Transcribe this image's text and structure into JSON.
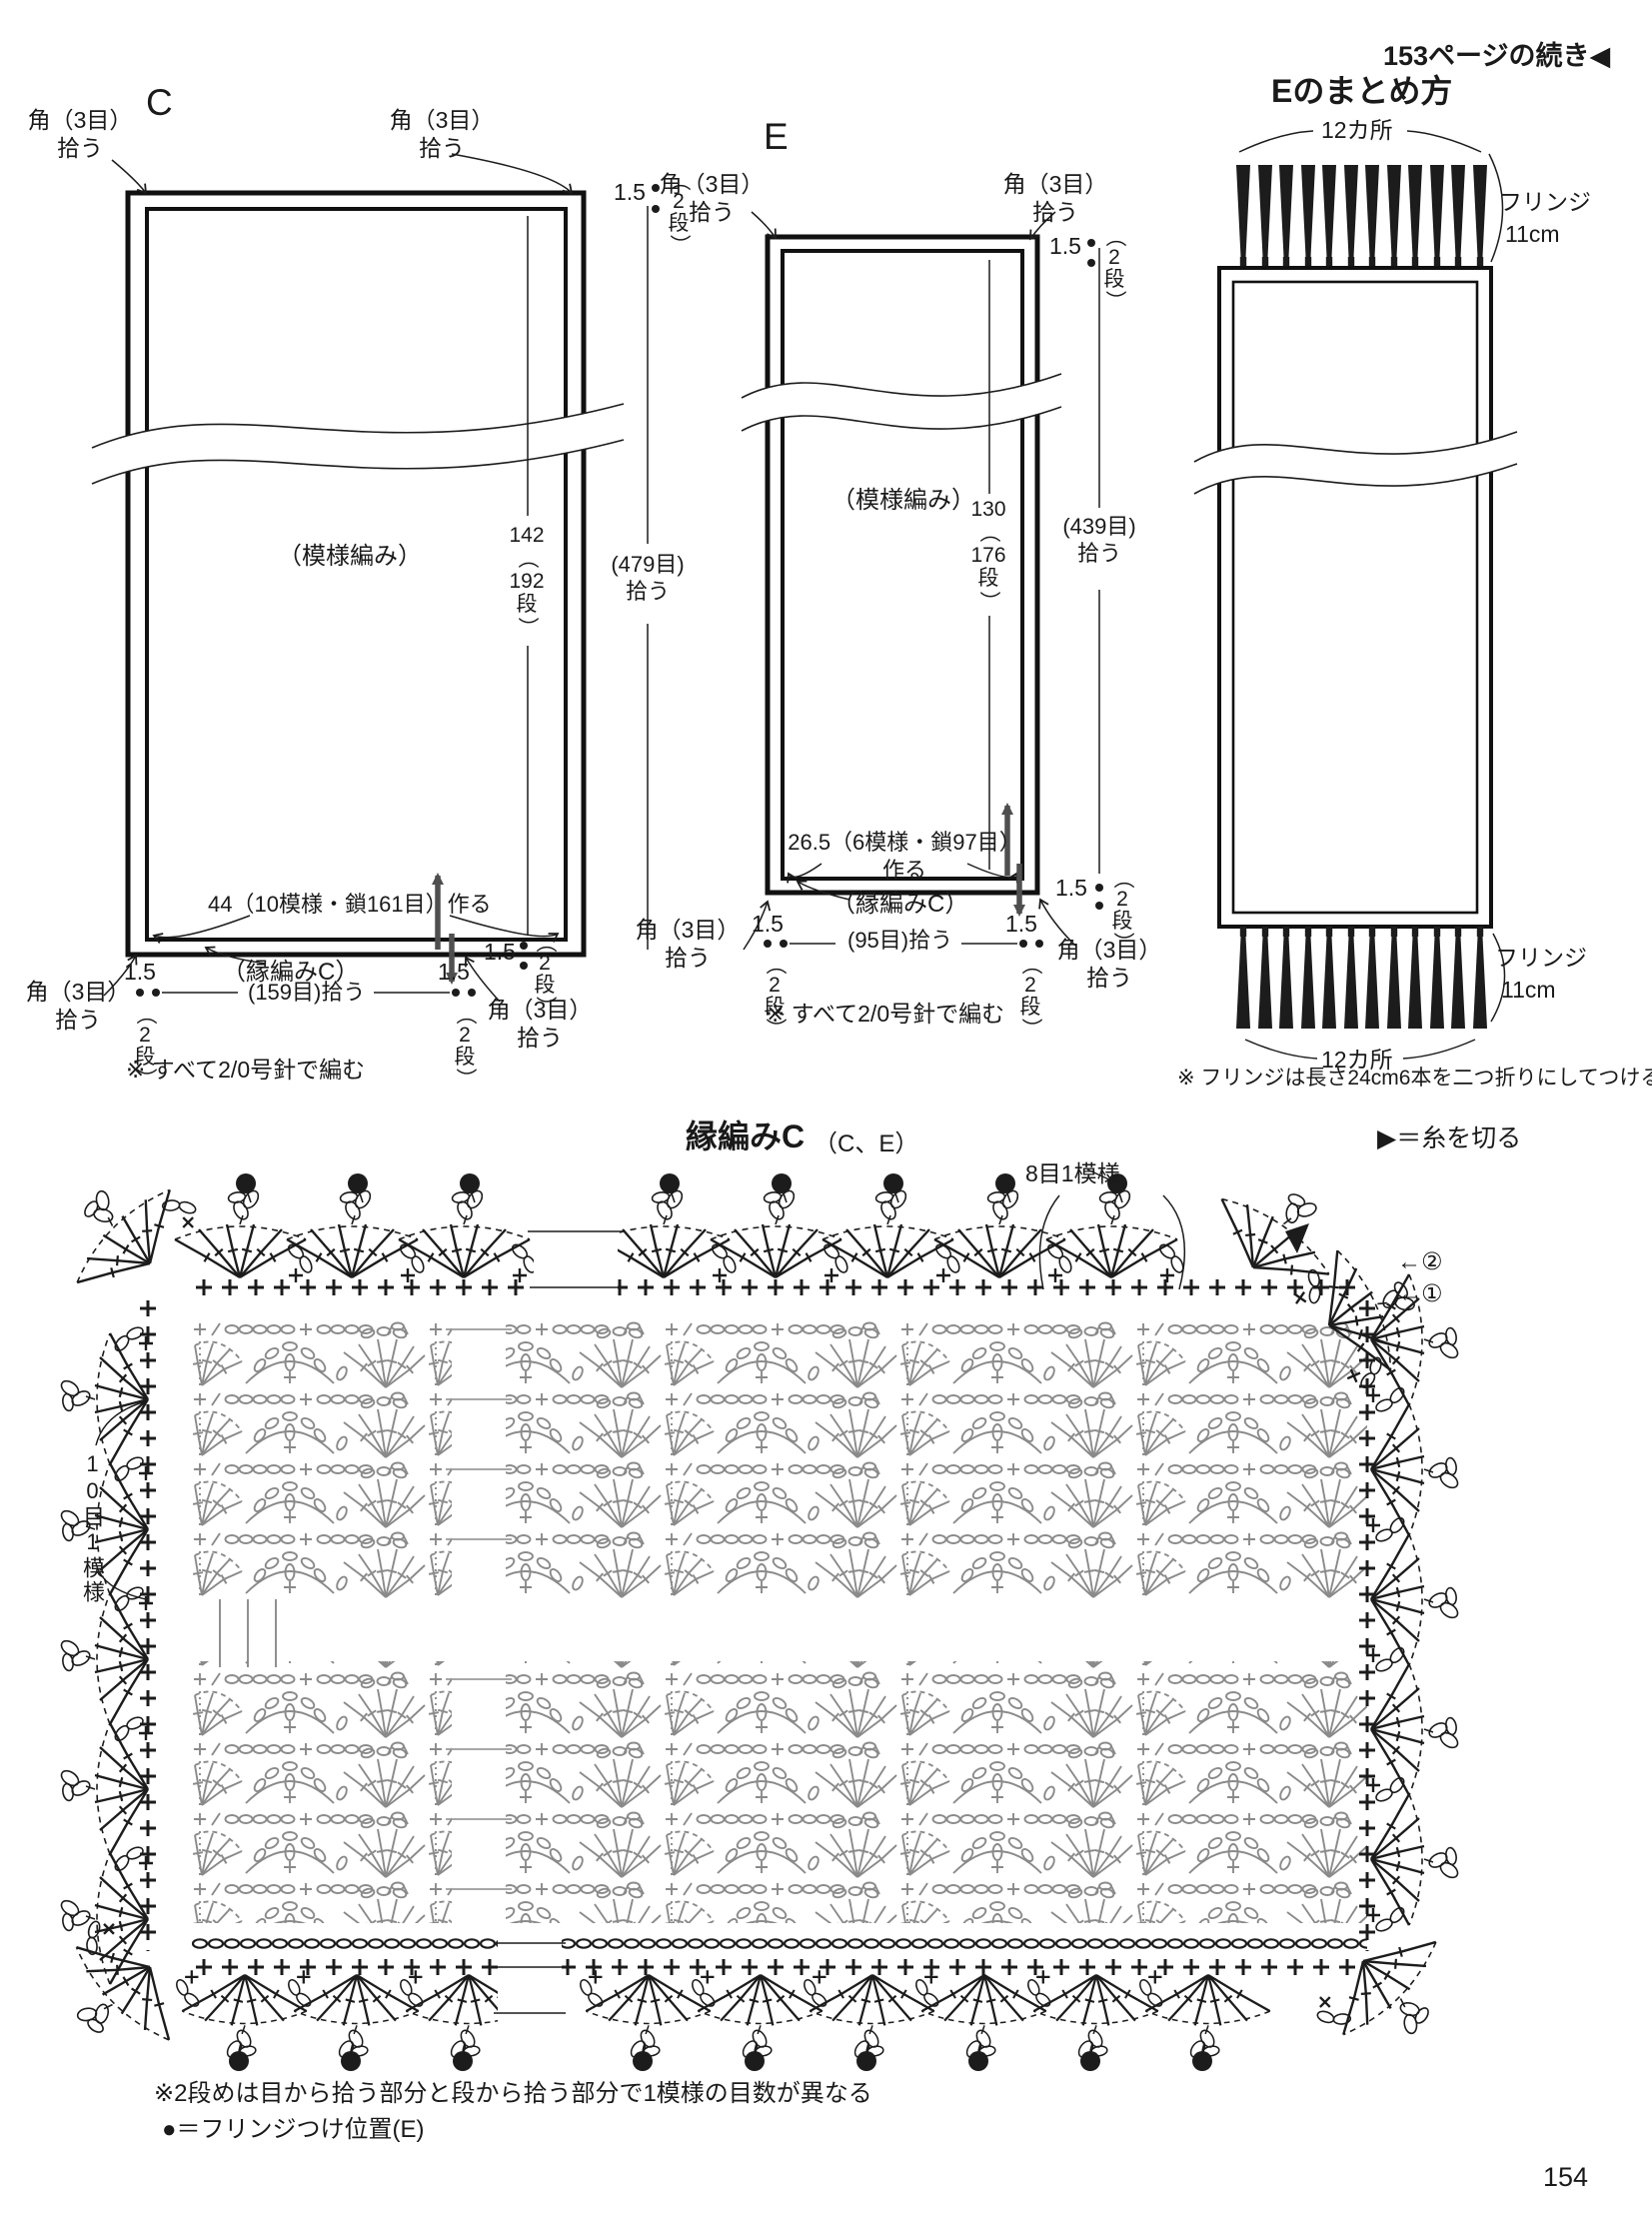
{
  "page": {
    "continued_from": "153ページの続き◀",
    "page_number": "154"
  },
  "shared": {
    "corner_line1": "角（3目）",
    "corner_line2": "拾う",
    "width_cm": "1.5",
    "paren_open": "（",
    "paren_close": "）",
    "two": "2",
    "dan": "段",
    "pickup": "拾う",
    "pattern_label": "（模様編み）",
    "edging_label": "（縁編みC）",
    "needle_note": "※ すべて2/0号針で編む"
  },
  "diagram_c": {
    "label": "C",
    "rows": "142",
    "rows_total": "192",
    "side_stitches": "(479目)",
    "cast_on": "44（10模様・鎖161目）作る",
    "bottom_stitches": "(159目)拾う"
  },
  "diagram_e": {
    "label": "E",
    "rows": "130",
    "rows_total": "176",
    "side_stitches": "(439目)",
    "cast_on": "26.5（6模様・鎖97目）",
    "cast_on_2": "作る",
    "bottom_stitches": "(95目)拾う"
  },
  "finishing": {
    "title": "Eのまとめ方",
    "places_top": "12カ所",
    "places_bottom": "12カ所",
    "fringe_top_line1": "フリンジ",
    "fringe_top_line2": "11cm",
    "fringe_bottom_line1": "フリンジ",
    "fringe_bottom_line2": "11cm",
    "note": "※ フリンジは長さ24cm6本を二つ折りにしてつける"
  },
  "chart": {
    "title": "縁編みC",
    "subtitle": "（C、E）",
    "legend_cut": "▶＝糸を切る",
    "repeat_top": "8目1模様",
    "repeat_side": "10目1模様",
    "row_2": "←②",
    "row_1": "←①",
    "note_rows": "※2段めは目から拾う部分と段から拾う部分で1模様の目数が異なる",
    "note_fringe": "●＝フリンジつけ位置(E)"
  },
  "colors": {
    "ink": "#1c1c1c",
    "pattern_gray": "#8a8a8a",
    "paper": "#ffffff"
  }
}
